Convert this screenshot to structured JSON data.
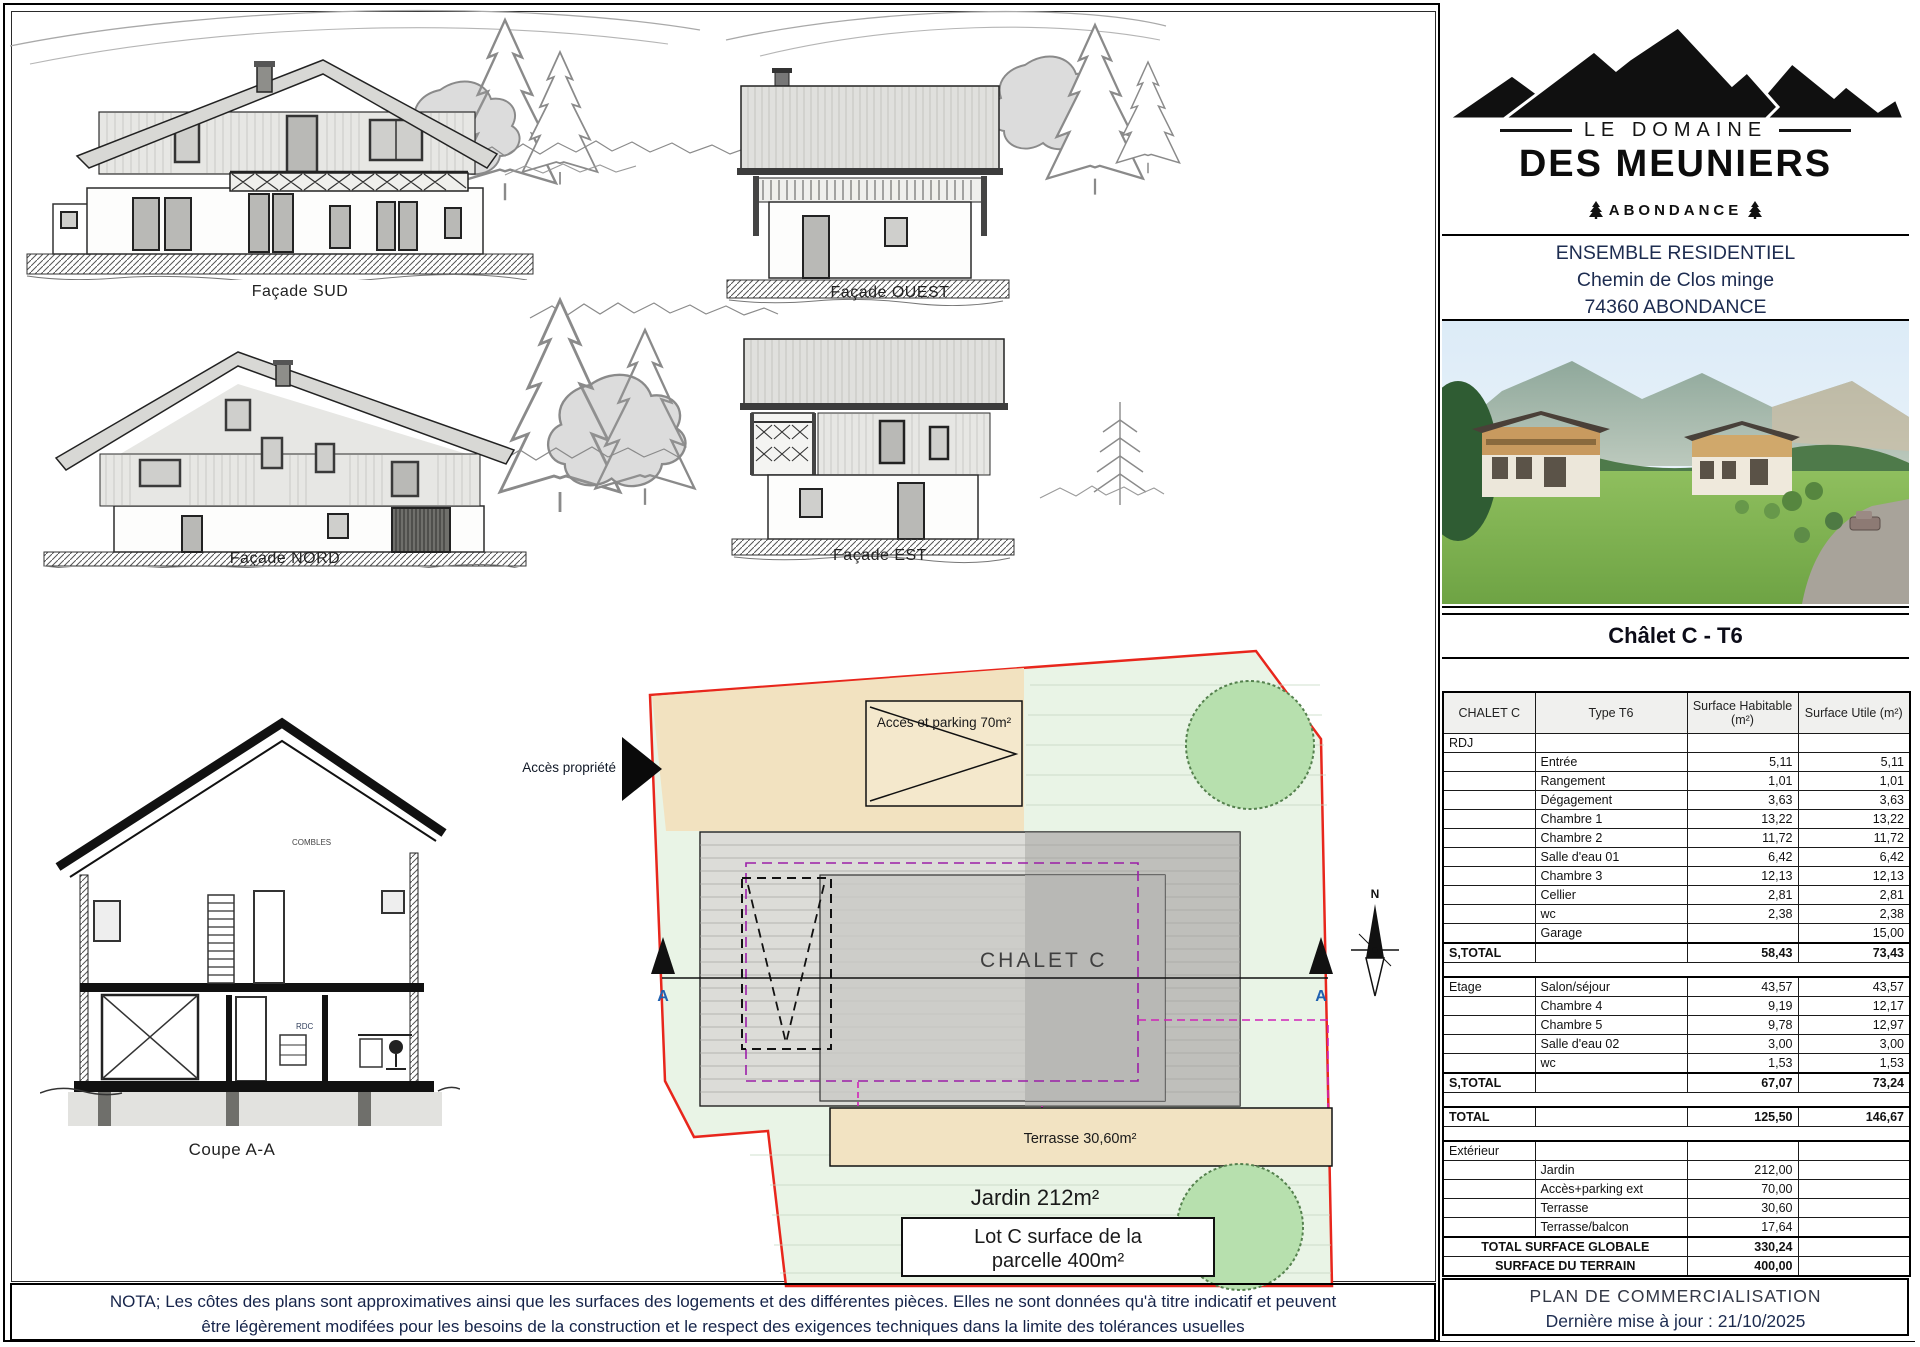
{
  "drawings": {
    "facade_sud_label": "Façade SUD",
    "facade_ouest_label": "Façade OUEST",
    "facade_nord_label": "Façade NORD",
    "facade_est_label": "Façade EST",
    "coupe_label": "Coupe A-A",
    "rdc_label": "RDC",
    "combles_label": "COMBLES"
  },
  "site_plan": {
    "acces_propriete": "Accès propriété",
    "acces_parking": "Accès et parking 70m²",
    "chalet_label": "CHALET C",
    "terrasse_label": "Terrasse 30,60m²",
    "jardin_label": "Jardin 212m²",
    "lot_box_line1": "Lot C surface de la",
    "lot_box_line2": "parcelle 400m²",
    "section_a_left": "A",
    "section_a_right": "A",
    "north_label": "N"
  },
  "nota": {
    "line1": "NOTA; Les côtes des plans sont approximatives ainsi que les surfaces des logements et des différentes pièces. Elles ne sont données qu'à titre indicatif et peuvent",
    "line2": "être légèrement modifées pour les besoins de la construction et le respect des exigences techniques dans la limite des tolérances usuelles"
  },
  "panel": {
    "brand": {
      "line1": "LE DOMAINE",
      "line2": "DES MEUNIERS",
      "location": "ABONDANCE"
    },
    "address": {
      "line1": "ENSEMBLE RESIDENTIEL",
      "line2": "Chemin de Clos minge",
      "line3": "74360 ABONDANCE"
    },
    "chalet_title": "Châlet C - T6",
    "table": {
      "col_headers": [
        "CHALET C",
        "Type T6",
        "Surface Habitable (m²)",
        "Surface Utile (m²)"
      ],
      "rdj_label": "RDJ",
      "rdj_rooms": [
        {
          "name": "Entrée",
          "hab": "5,11",
          "utile": "5,11"
        },
        {
          "name": "Rangement",
          "hab": "1,01",
          "utile": "1,01"
        },
        {
          "name": "Dégagement",
          "hab": "3,63",
          "utile": "3,63"
        },
        {
          "name": "Chambre 1",
          "hab": "13,22",
          "utile": "13,22"
        },
        {
          "name": "Chambre 2",
          "hab": "11,72",
          "utile": "11,72"
        },
        {
          "name": "Salle d'eau 01",
          "hab": "6,42",
          "utile": "6,42"
        },
        {
          "name": "Chambre 3",
          "hab": "12,13",
          "utile": "12,13"
        },
        {
          "name": "Cellier",
          "hab": "2,81",
          "utile": "2,81"
        },
        {
          "name": "wc",
          "hab": "2,38",
          "utile": "2,38"
        },
        {
          "name": "Garage",
          "hab": "",
          "utile": "15,00"
        }
      ],
      "rdj_subtotal": {
        "label": "S,TOTAL",
        "hab": "58,43",
        "utile": "73,43"
      },
      "etage_label": "Etage",
      "etage_rooms": [
        {
          "name": "Salon/séjour",
          "hab": "43,57",
          "utile": "43,57"
        },
        {
          "name": "Chambre 4",
          "hab": "9,19",
          "utile": "12,17"
        },
        {
          "name": "Chambre 5",
          "hab": "9,78",
          "utile": "12,97"
        },
        {
          "name": "Salle d'eau 02",
          "hab": "3,00",
          "utile": "3,00"
        },
        {
          "name": "wc",
          "hab": "1,53",
          "utile": "1,53"
        }
      ],
      "etage_subtotal": {
        "label": "S,TOTAL",
        "hab": "67,07",
        "utile": "73,24"
      },
      "total": {
        "label": "TOTAL",
        "hab": "125,50",
        "utile": "146,67"
      },
      "exterieur_label": "Extérieur",
      "exterieur_rooms": [
        {
          "name": "Jardin",
          "hab": "212,00",
          "utile": ""
        },
        {
          "name": "Accès+parking ext",
          "hab": "70,00",
          "utile": ""
        },
        {
          "name": "Terrasse",
          "hab": "30,60",
          "utile": ""
        },
        {
          "name": "Terrasse/balcon",
          "hab": "17,64",
          "utile": ""
        }
      ],
      "total_globale": {
        "label": "TOTAL SURFACE GLOBALE",
        "value": "330,24"
      },
      "terrain": {
        "label": "SURFACE DU TERRAIN",
        "value": "400,00"
      }
    },
    "footer": {
      "line1": "PLAN DE COMMERCIALISATION",
      "line2": "Dernière mise à jour : 21/10/2025"
    }
  },
  "colors": {
    "parcel_boundary": "#e8261c",
    "beige_zone": "#f2e2c0",
    "lawn_zone": "#e9f4e6",
    "tree_fill": "#b7e0ae",
    "building_gray": "#dcdcd8",
    "purple_dash": "#9b1fa8",
    "magenta_dash": "#d023b8",
    "navy_text": "#1d2c50"
  }
}
